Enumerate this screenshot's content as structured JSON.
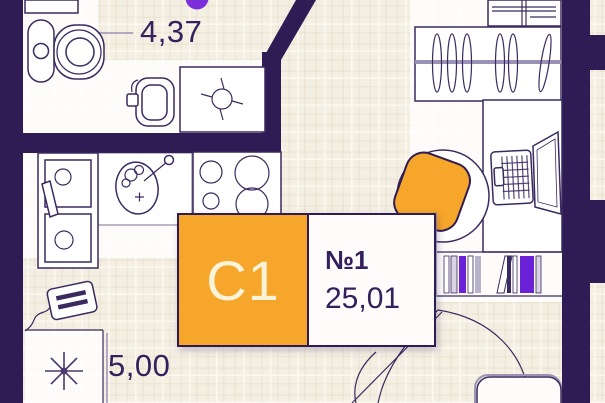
{
  "unit_card": {
    "type_code": "С1",
    "number": "№1",
    "area": "25,01"
  },
  "area_labels": {
    "hallway": "4,37",
    "left_room": "5,00"
  },
  "colors": {
    "wall": "#2F1C55",
    "accent_orange": "#F5A62B",
    "card_code_text": "#FBF3D8",
    "label_text": "#33205C",
    "accent_purple": "#7B2FD8",
    "background": "#F4EFE3",
    "outline": "#3A2A60",
    "light_line": "#9B93B5",
    "floor": "#FFFFFF"
  },
  "rooms": [
    {
      "name": "hallway",
      "area_label": "4,37"
    },
    {
      "name": "bathroom"
    },
    {
      "name": "kitchen"
    },
    {
      "name": "left-room",
      "area_label": "5,00"
    },
    {
      "name": "main-room"
    }
  ],
  "furniture": [
    "toilet",
    "washbasin",
    "shower",
    "double-sink-unit",
    "round-sink",
    "stove",
    "electrical-panel",
    "lamp-symbol",
    "shelf-unit",
    "wardrobe-hangers",
    "desk",
    "laptop",
    "office-chair",
    "bookshelf",
    "sofa-bed",
    "pillow"
  ]
}
